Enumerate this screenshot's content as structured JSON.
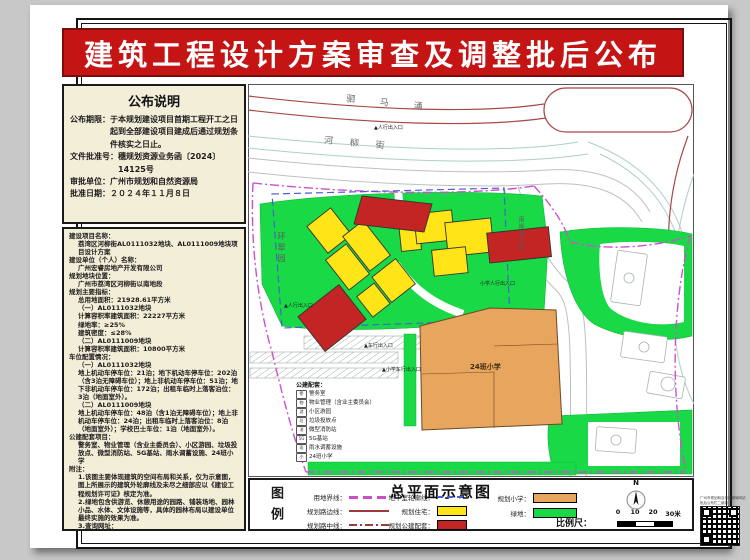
{
  "banner": {
    "title": "建筑工程设计方案审查及调整批后公布"
  },
  "notice": {
    "title": "公布说明",
    "lines": [
      {
        "label": "公布期限：",
        "text": "于本规划建设项目首期工程开工之日起到全部建设项目建成后通过规划条件核实之日止。"
      },
      {
        "label": "文件批准号：",
        "text": "穗规划资源业务函〔2024〕14125号"
      },
      {
        "label": "审批单位：",
        "text": "广州市规划和自然资源局"
      },
      {
        "label": "批准日期：",
        "text": "２０２４年１１月８日"
      }
    ]
  },
  "details": {
    "lines": [
      {
        "t": "建设项目名称：",
        "i": 0
      },
      {
        "t": "荔湾区河柳街AL0111032地块、AL0111009地块项目设计方案",
        "i": 1
      },
      {
        "t": "建设单位（个人）名称：",
        "i": 0
      },
      {
        "t": "广州宏睿房地产开发有限公司",
        "i": 1
      },
      {
        "t": "规划地块位置：",
        "i": 0
      },
      {
        "t": "广州市荔湾区河柳街以南地段",
        "i": 1
      },
      {
        "t": "规划主要指标：",
        "i": 0
      },
      {
        "t": "总用地面积：21928.61平方米",
        "i": 1
      },
      {
        "t": "（一）AL0111032地块",
        "i": 1
      },
      {
        "t": "计算容积率建筑面积：22227平方米",
        "i": 1
      },
      {
        "t": "绿地率：≥25%",
        "i": 1
      },
      {
        "t": "建筑密度：≤28%",
        "i": 1
      },
      {
        "t": "（二）AL0111009地块",
        "i": 1
      },
      {
        "t": "计算容积率建筑面积：10800平方米",
        "i": 1
      },
      {
        "t": "车位配置情况：",
        "i": 0
      },
      {
        "t": "（一）AL0111032地块",
        "i": 1
      },
      {
        "t": "地上机动车停车位：21泊；地下机动车停车位：202泊（含3泊无障碍车位）；地上非机动车停车位：51泊；地下非机动车停车位：172泊；出租车临时上落客泊位：3泊（地面室外）。",
        "i": 1
      },
      {
        "t": "（二）AL0111009地块",
        "i": 1
      },
      {
        "t": "地上机动车停车位：48泊（含1泊无障碍车位）；地上非机动车停车位：24泊；出租车临时上落客泊位：8泊（地面室外）；学校巴士车位：1泊（地面室外）。",
        "i": 1
      },
      {
        "t": "公建配套项目：",
        "i": 0
      },
      {
        "t": "警务室、物业管理（含业主委员会）、小区游园、垃圾投放点、微型消防站、5G基站、雨水调蓄设施、24班小学",
        "i": 1
      },
      {
        "t": "附注：",
        "i": 0
      },
      {
        "t": "1.该图主要体现建筑的空间布局和关系，仅为示意图，图上所展示的建筑外轮廓线及未尽之细部应以《建设工程规划许可证》核定为准。",
        "i": 1
      },
      {
        "t": "2.绿地包含供游览、休憩用途的园路、铺装场地、园林小品、水体、文体设施等，具体的园林布局以建设单位最终实施的效果为准。",
        "i": 1
      },
      {
        "t": "3.查询网址：",
        "i": 1
      },
      {
        "t": "http://ghzyj.gz.gov.cn/ywpd/cxgh/ghwkgsgb/phgb/gbt/",
        "i": 1
      }
    ]
  },
  "map": {
    "labels": [
      {
        "t": "驷 马 涌",
        "x": 98,
        "y": 12,
        "rot": 6,
        "cls": "roadname"
      },
      {
        "t": "河 柳 街",
        "x": 76,
        "y": 52,
        "rot": 5,
        "cls": "roadname2"
      },
      {
        "t": "环翠园",
        "x": 28,
        "y": 148,
        "cls": "vroad"
      },
      {
        "t": "南岸涌大街",
        "x": 268,
        "y": 132,
        "cls": "vsmall"
      },
      {
        "t": "▲人行出入口",
        "x": 126,
        "y": 40,
        "cls": "tiny"
      },
      {
        "t": "▲人行出入口",
        "x": 36,
        "y": 218,
        "cls": "tiny"
      },
      {
        "t": "▲车行出入口",
        "x": 116,
        "y": 258,
        "cls": "tiny"
      },
      {
        "t": "小学人行出入口",
        "x": 232,
        "y": 196,
        "cls": "tiny"
      },
      {
        "t": "▲小学车行出入口",
        "x": 134,
        "y": 282,
        "cls": "tiny"
      },
      {
        "t": "24班小学",
        "x": 222,
        "y": 278,
        "cls": "bldg-label"
      }
    ],
    "facilities": {
      "title": "公建配套：",
      "items": [
        {
          "icon": "警",
          "label": "警务室"
        },
        {
          "icon": "物",
          "label": "物业管理（含业主委员会）"
        },
        {
          "icon": "游",
          "label": "小区游园"
        },
        {
          "icon": "垃",
          "label": "垃圾投放点"
        },
        {
          "icon": "消",
          "label": "微型消防站"
        },
        {
          "icon": "5G",
          "label": "5G基站"
        },
        {
          "icon": "雨",
          "label": "雨水调蓄设施"
        },
        {
          "icon": "小",
          "label": "24班小学"
        }
      ]
    }
  },
  "legend": {
    "side_label": "图例",
    "title": "总平面示意图",
    "items": [
      {
        "label": "用地界线：",
        "swatch": "dashes",
        "color": "#c94fc9",
        "x": 38,
        "y": 12,
        "w": 58,
        "sw": 40
      },
      {
        "label": "规划路边线：",
        "swatch": "solid",
        "color": "#9c3b3b",
        "x": 38,
        "y": 26,
        "w": 58,
        "sw": 40
      },
      {
        "label": "规划路中线：",
        "swatch": "dashdot",
        "color": "#9c3b3b",
        "x": 38,
        "y": 40,
        "w": 58,
        "sw": 40
      },
      {
        "label": "地下室轮廓线：",
        "swatch": "dashed",
        "color": "#4a5fd0",
        "x": 120,
        "y": 12,
        "w": 64,
        "sw": 28
      },
      {
        "label": "规划住宅：",
        "swatch": "box",
        "color": "#ffe418",
        "x": 120,
        "y": 26,
        "w": 64,
        "sw": 28
      },
      {
        "label": "规划公建配套：",
        "swatch": "box",
        "color": "#c32424",
        "x": 120,
        "y": 40,
        "w": 64,
        "sw": 28
      },
      {
        "label": "规划小学：",
        "swatch": "box",
        "color": "#e8a55e",
        "x": 236,
        "y": 13,
        "w": 44,
        "sw": 42
      },
      {
        "label": "绿地：",
        "swatch": "box",
        "color": "#19d947",
        "x": 236,
        "y": 28,
        "w": 44,
        "sw": 42
      }
    ],
    "scale": {
      "label": "比例尺：",
      "ticks": [
        {
          "t": "0",
          "x": 368
        },
        {
          "t": "10",
          "x": 385
        },
        {
          "t": "20",
          "x": 403
        },
        {
          "t": "30米",
          "x": 423
        }
      ]
    },
    "compass": "N"
  },
  "qr": {
    "caption1": "广州市规划和自然资源局网站",
    "caption2": "批后公布栏二维码"
  }
}
